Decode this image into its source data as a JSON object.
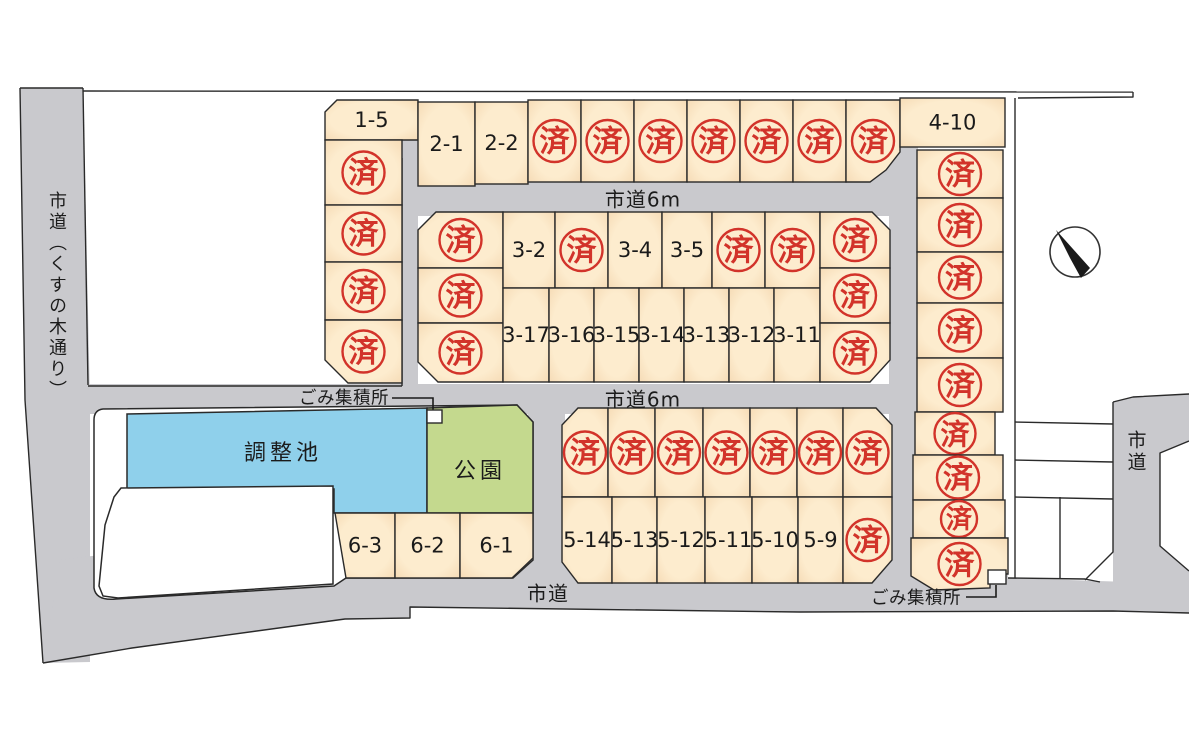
{
  "map": {
    "stamp": "済",
    "colors": {
      "lot_fill": "#fdecce",
      "lot_edge": "#f3d5ad",
      "road": "#c9c9cd",
      "pond": "#8fd0eb",
      "park": "#c4d98e",
      "stamp": "#d2332a",
      "line": "#2a2a2a",
      "white": "#ffffff"
    },
    "roads": {
      "left": "市道（くすの木通り）",
      "top": "市道6m",
      "middle": "市道6m",
      "bottom": "市道",
      "right": "市道"
    },
    "features": {
      "pond": "調整池",
      "park": "公園",
      "garbage_top": "ごみ集積所",
      "garbage_bottom": "ごみ集積所"
    },
    "lots": [
      {
        "label": "1-5",
        "sold": false,
        "pts": [
          [
            325,
            112
          ],
          [
            337,
            100
          ],
          [
            418,
            100
          ],
          [
            418,
            140
          ],
          [
            325,
            140
          ]
        ]
      },
      {
        "sold": true,
        "g": [
          325,
          140,
          77,
          65
        ]
      },
      {
        "sold": true,
        "g": [
          325,
          205,
          77,
          57
        ]
      },
      {
        "sold": true,
        "g": [
          325,
          262,
          77,
          58
        ]
      },
      {
        "sold": true,
        "pts": [
          [
            325,
            320
          ],
          [
            402,
            320
          ],
          [
            402,
            383
          ],
          [
            348,
            383
          ],
          [
            325,
            360
          ]
        ]
      },
      {
        "label": "2-1",
        "sold": false,
        "g": [
          418,
          102,
          57,
          84
        ]
      },
      {
        "label": "2-2",
        "sold": false,
        "g": [
          475,
          102,
          53,
          82
        ]
      },
      {
        "sold": true,
        "g": [
          528,
          100,
          53,
          82
        ]
      },
      {
        "sold": true,
        "g": [
          581,
          100,
          53,
          82
        ]
      },
      {
        "sold": true,
        "g": [
          634,
          100,
          53,
          82
        ]
      },
      {
        "sold": true,
        "g": [
          687,
          100,
          53,
          82
        ]
      },
      {
        "sold": true,
        "g": [
          740,
          100,
          53,
          82
        ]
      },
      {
        "sold": true,
        "g": [
          793,
          100,
          53,
          82
        ]
      },
      {
        "sold": true,
        "pts": [
          [
            846,
            100
          ],
          [
            900,
            100
          ],
          [
            900,
            152
          ],
          [
            886,
            170
          ],
          [
            870,
            182
          ],
          [
            846,
            182
          ]
        ]
      },
      {
        "label": "4-10",
        "sold": false,
        "g": [
          900,
          98,
          105,
          49
        ]
      },
      {
        "sold": true,
        "pts": [
          [
            418,
            230
          ],
          [
            436,
            212
          ],
          [
            503,
            212
          ],
          [
            503,
            268
          ],
          [
            418,
            268
          ]
        ]
      },
      {
        "sold": true,
        "g": [
          418,
          268,
          85,
          55
        ]
      },
      {
        "sold": true,
        "pts": [
          [
            418,
            323
          ],
          [
            503,
            323
          ],
          [
            503,
            382
          ],
          [
            438,
            382
          ],
          [
            418,
            362
          ]
        ]
      },
      {
        "label": "3-2",
        "sold": false,
        "g": [
          503,
          212,
          52,
          76
        ]
      },
      {
        "sold": true,
        "g": [
          555,
          212,
          53,
          76
        ]
      },
      {
        "label": "3-4",
        "sold": false,
        "g": [
          608,
          212,
          54,
          76
        ]
      },
      {
        "label": "3-5",
        "sold": false,
        "g": [
          662,
          212,
          50,
          76
        ]
      },
      {
        "sold": true,
        "g": [
          712,
          212,
          53,
          76
        ]
      },
      {
        "sold": true,
        "g": [
          765,
          212,
          55,
          76
        ]
      },
      {
        "label": "3-17",
        "sold": false,
        "g": [
          503,
          288,
          46,
          94
        ]
      },
      {
        "label": "3-16",
        "sold": false,
        "g": [
          549,
          288,
          45,
          94
        ]
      },
      {
        "label": "3-15",
        "sold": false,
        "g": [
          594,
          288,
          45,
          94
        ]
      },
      {
        "label": "3-14",
        "sold": false,
        "g": [
          639,
          288,
          45,
          94
        ]
      },
      {
        "label": "3-13",
        "sold": false,
        "g": [
          684,
          288,
          45,
          94
        ]
      },
      {
        "label": "3-12",
        "sold": false,
        "g": [
          729,
          288,
          45,
          94
        ]
      },
      {
        "label": "3-11",
        "sold": false,
        "g": [
          774,
          288,
          46,
          94
        ]
      },
      {
        "sold": true,
        "pts": [
          [
            820,
            212
          ],
          [
            872,
            212
          ],
          [
            890,
            230
          ],
          [
            890,
            268
          ],
          [
            820,
            268
          ]
        ]
      },
      {
        "sold": true,
        "g": [
          820,
          268,
          70,
          55
        ]
      },
      {
        "sold": true,
        "pts": [
          [
            820,
            323
          ],
          [
            890,
            323
          ],
          [
            890,
            360
          ],
          [
            870,
            382
          ],
          [
            820,
            382
          ]
        ]
      },
      {
        "sold": true,
        "g": [
          917,
          150,
          86,
          48
        ]
      },
      {
        "sold": true,
        "g": [
          917,
          198,
          86,
          54
        ]
      },
      {
        "sold": true,
        "g": [
          917,
          252,
          86,
          51
        ]
      },
      {
        "sold": true,
        "g": [
          917,
          303,
          86,
          55
        ]
      },
      {
        "sold": true,
        "g": [
          917,
          358,
          86,
          54
        ]
      },
      {
        "sold": true,
        "g": [
          915,
          412,
          80,
          43
        ]
      },
      {
        "sold": true,
        "g": [
          913,
          455,
          90,
          45
        ]
      },
      {
        "sold": true,
        "g": [
          913,
          500,
          92,
          38
        ]
      },
      {
        "sold": true,
        "pts": [
          [
            911,
            538
          ],
          [
            1008,
            538
          ],
          [
            1008,
            574
          ],
          [
            990,
            574
          ],
          [
            990,
            588
          ],
          [
            934,
            590
          ],
          [
            911,
            576
          ]
        ]
      },
      {
        "sold": true,
        "pts": [
          [
            562,
            425
          ],
          [
            578,
            408
          ],
          [
            608,
            408
          ],
          [
            608,
            497
          ],
          [
            562,
            497
          ]
        ]
      },
      {
        "sold": true,
        "g": [
          608,
          408,
          47,
          89
        ]
      },
      {
        "sold": true,
        "g": [
          655,
          408,
          48,
          89
        ]
      },
      {
        "sold": true,
        "g": [
          703,
          408,
          47,
          89
        ]
      },
      {
        "sold": true,
        "g": [
          750,
          408,
          47,
          89
        ]
      },
      {
        "sold": true,
        "g": [
          797,
          408,
          46,
          89
        ]
      },
      {
        "sold": true,
        "pts": [
          [
            843,
            408
          ],
          [
            876,
            408
          ],
          [
            892,
            425
          ],
          [
            892,
            497
          ],
          [
            843,
            497
          ]
        ]
      },
      {
        "label": "5-14",
        "sold": false,
        "pts": [
          [
            562,
            497
          ],
          [
            612,
            497
          ],
          [
            612,
            583
          ],
          [
            578,
            583
          ],
          [
            562,
            562
          ]
        ]
      },
      {
        "label": "5-13",
        "sold": false,
        "g": [
          612,
          497,
          45,
          86
        ]
      },
      {
        "label": "5-12",
        "sold": false,
        "g": [
          657,
          497,
          48,
          86
        ]
      },
      {
        "label": "5-11",
        "sold": false,
        "g": [
          705,
          497,
          47,
          86
        ]
      },
      {
        "label": "5-10",
        "sold": false,
        "g": [
          752,
          497,
          46,
          86
        ]
      },
      {
        "label": "5-9",
        "sold": false,
        "g": [
          798,
          497,
          45,
          86
        ]
      },
      {
        "sold": true,
        "pts": [
          [
            843,
            497
          ],
          [
            892,
            497
          ],
          [
            892,
            560
          ],
          [
            872,
            583
          ],
          [
            843,
            583
          ]
        ]
      },
      {
        "label": "6-3",
        "sold": false,
        "pts": [
          [
            335,
            513
          ],
          [
            395,
            513
          ],
          [
            395,
            578
          ],
          [
            346,
            578
          ]
        ]
      },
      {
        "label": "6-2",
        "sold": false,
        "g": [
          395,
          513,
          65,
          65
        ]
      },
      {
        "label": "6-1",
        "sold": false,
        "pts": [
          [
            460,
            513
          ],
          [
            533,
            513
          ],
          [
            533,
            558
          ],
          [
            512,
            578
          ],
          [
            460,
            578
          ]
        ]
      }
    ]
  }
}
